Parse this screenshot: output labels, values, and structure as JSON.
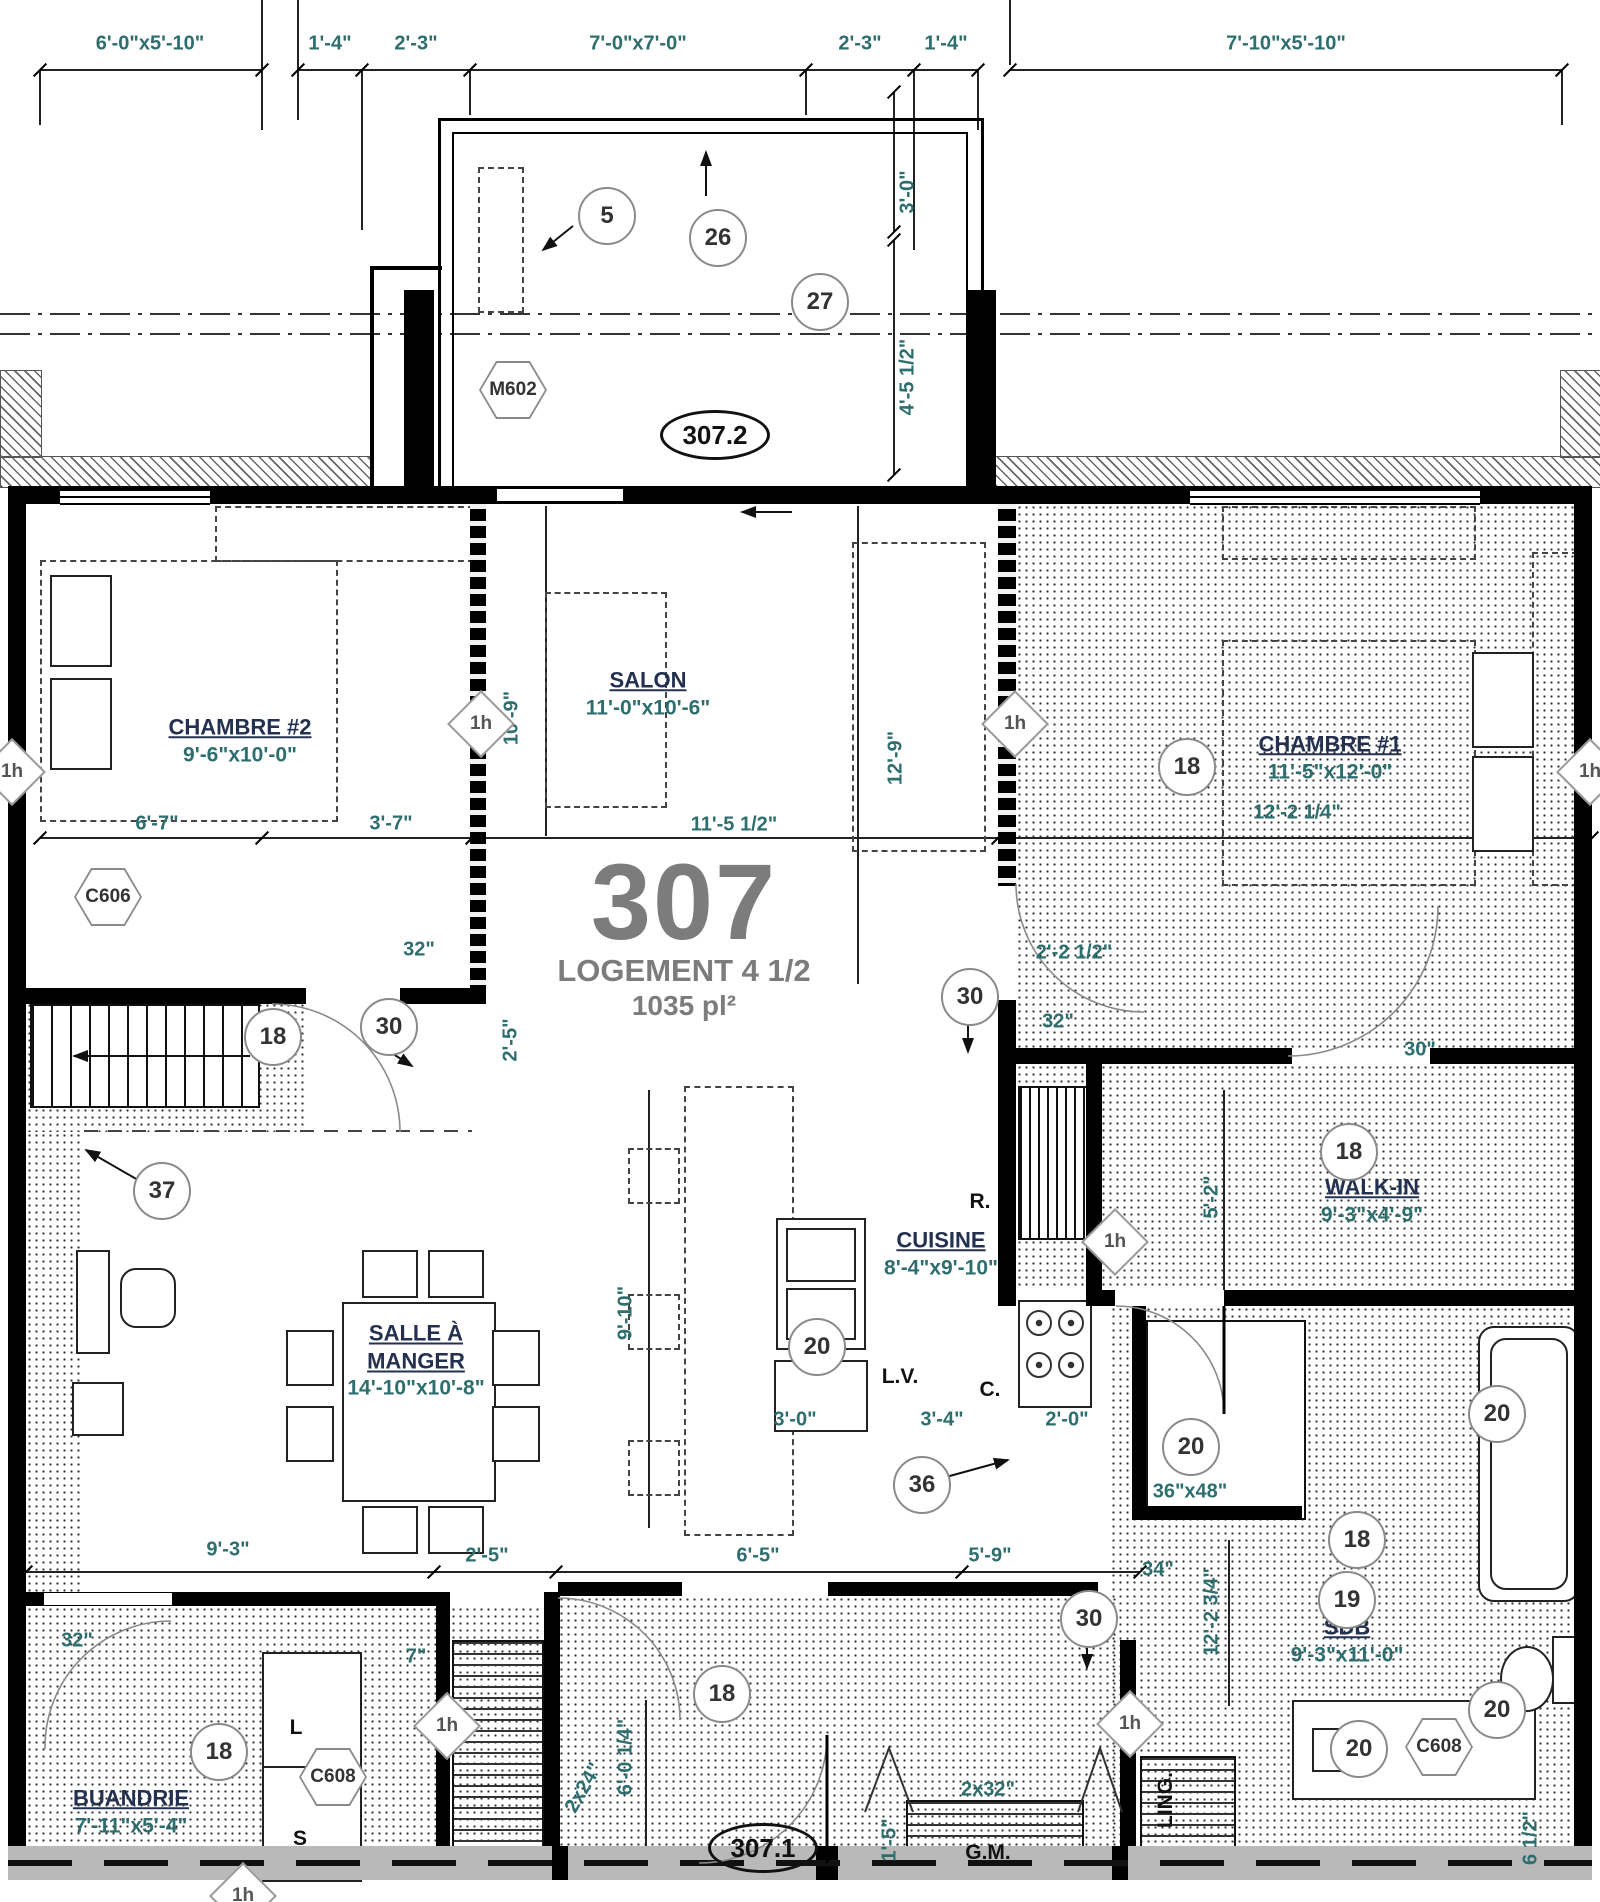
{
  "title": {
    "unit": "307",
    "type": "LOGEMENT 4 1/2",
    "area": "1035 pl²"
  },
  "colors": {
    "dim_text": "#2e6e6e",
    "room_text": "#233050",
    "title_text": "#7c7c7c",
    "wall": "#000000",
    "band": "#b9b9b9"
  },
  "top_dims": [
    {
      "t": "6'-0\"x5'-10\"",
      "x": 150,
      "y": 44
    },
    {
      "t": "1'-4\"",
      "x": 330,
      "y": 44
    },
    {
      "t": "2'-3\"",
      "x": 416,
      "y": 44
    },
    {
      "t": "7'-0\"x7'-0\"",
      "x": 638,
      "y": 44
    },
    {
      "t": "2'-3\"",
      "x": 860,
      "y": 44
    },
    {
      "t": "1'-4\"",
      "x": 946,
      "y": 44
    },
    {
      "t": "7'-10\"x5'-10\"",
      "x": 1286,
      "y": 44
    }
  ],
  "dims": [
    {
      "t": "3'-0\"",
      "x": 908,
      "y": 192,
      "rot": true
    },
    {
      "t": "4'-5 1/2\"",
      "x": 908,
      "y": 377,
      "rot": true
    },
    {
      "t": "10'-9\"",
      "x": 512,
      "y": 718,
      "rot": true
    },
    {
      "t": "12'-9\"",
      "x": 896,
      "y": 758,
      "rot": true
    },
    {
      "t": "6'-7\"",
      "x": 157,
      "y": 824
    },
    {
      "t": "3'-7\"",
      "x": 391,
      "y": 824
    },
    {
      "t": "11'-5 1/2\"",
      "x": 734,
      "y": 825
    },
    {
      "t": "12'-2 1/4\"",
      "x": 1297,
      "y": 813
    },
    {
      "t": "32\"",
      "x": 419,
      "y": 950
    },
    {
      "t": "2'-5\"",
      "x": 511,
      "y": 1040,
      "rot": true
    },
    {
      "t": "2'-2 1/2\"",
      "x": 1074,
      "y": 953
    },
    {
      "t": "32\"",
      "x": 1058,
      "y": 1022
    },
    {
      "t": "30\"",
      "x": 1420,
      "y": 1050
    },
    {
      "t": "5'-2\"",
      "x": 1212,
      "y": 1197,
      "rot": true
    },
    {
      "t": "9'-10\"",
      "x": 626,
      "y": 1313,
      "rot": true
    },
    {
      "t": "3'-0\"",
      "x": 795,
      "y": 1420
    },
    {
      "t": "3'-4\"",
      "x": 942,
      "y": 1420
    },
    {
      "t": "2'-0\"",
      "x": 1067,
      "y": 1420
    },
    {
      "t": "36\"x48\"",
      "x": 1190,
      "y": 1492
    },
    {
      "t": "9'-3\"",
      "x": 228,
      "y": 1550
    },
    {
      "t": "2'-5\"",
      "x": 487,
      "y": 1556
    },
    {
      "t": "6'-5\"",
      "x": 758,
      "y": 1556
    },
    {
      "t": "5'-9\"",
      "x": 990,
      "y": 1556
    },
    {
      "t": "34\"",
      "x": 1158,
      "y": 1570
    },
    {
      "t": "12'-2 3/4\"",
      "x": 1212,
      "y": 1612,
      "rot": true
    },
    {
      "t": "32\"",
      "x": 77,
      "y": 1641
    },
    {
      "t": "7\"",
      "x": 416,
      "y": 1657
    },
    {
      "t": "2x24\"",
      "x": 584,
      "y": 1788,
      "rot60": true
    },
    {
      "t": "6'-0 1/4\"",
      "x": 626,
      "y": 1757,
      "rot": true
    },
    {
      "t": "1'-5\"",
      "x": 890,
      "y": 1840,
      "rot": true
    },
    {
      "t": "2x32\"",
      "x": 988,
      "y": 1790
    },
    {
      "t": "6 1/2\"",
      "x": 1531,
      "y": 1838,
      "rot": true
    }
  ],
  "rooms": [
    {
      "name": "CHAMBRE #2",
      "size": "9'-6\"x10'-0\"",
      "x": 240,
      "y": 740
    },
    {
      "name": "SALON",
      "size": "11'-0\"x10'-6\"",
      "x": 648,
      "y": 693
    },
    {
      "name": "CHAMBRE #1",
      "size": "11'-5\"x12'-0\"",
      "x": 1330,
      "y": 757
    },
    {
      "name": "WALK-IN",
      "size": "9'-3\"x4'-9\"",
      "x": 1372,
      "y": 1200
    },
    {
      "name": "SALLE À\nMANGER",
      "size": "14'-10\"x10'-8\"",
      "x": 416,
      "y": 1360
    },
    {
      "name": "CUISINE",
      "size": "8'-4\"x9'-10\"",
      "x": 941,
      "y": 1253
    },
    {
      "name": "SDB",
      "size": "9'-3\"x11'-0\"",
      "x": 1347,
      "y": 1640
    },
    {
      "name": "BUANDRIE",
      "size": "7'-11\"x5'-4\"",
      "x": 131,
      "y": 1811
    }
  ],
  "circles": [
    {
      "n": "5",
      "x": 605,
      "y": 214
    },
    {
      "n": "26",
      "x": 716,
      "y": 236
    },
    {
      "n": "27",
      "x": 818,
      "y": 300
    },
    {
      "n": "18",
      "x": 1185,
      "y": 765
    },
    {
      "n": "30",
      "x": 387,
      "y": 1025
    },
    {
      "n": "18",
      "x": 271,
      "y": 1035
    },
    {
      "n": "30",
      "x": 968,
      "y": 995
    },
    {
      "n": "37",
      "x": 160,
      "y": 1189
    },
    {
      "n": "18",
      "x": 1347,
      "y": 1150
    },
    {
      "n": "20",
      "x": 815,
      "y": 1345
    },
    {
      "n": "36",
      "x": 920,
      "y": 1483
    },
    {
      "n": "20",
      "x": 1189,
      "y": 1445
    },
    {
      "n": "20",
      "x": 1495,
      "y": 1412
    },
    {
      "n": "18",
      "x": 1355,
      "y": 1538
    },
    {
      "n": "19",
      "x": 1345,
      "y": 1598
    },
    {
      "n": "30",
      "x": 1087,
      "y": 1617
    },
    {
      "n": "18",
      "x": 720,
      "y": 1692
    },
    {
      "n": "18",
      "x": 217,
      "y": 1750
    },
    {
      "n": "20",
      "x": 1357,
      "y": 1747
    },
    {
      "n": "20",
      "x": 1495,
      "y": 1708
    }
  ],
  "hexes": [
    {
      "n": "M602",
      "x": 513,
      "y": 390
    },
    {
      "n": "C606",
      "x": 108,
      "y": 897
    },
    {
      "n": "C608",
      "x": 333,
      "y": 1777
    },
    {
      "n": "C608",
      "x": 1439,
      "y": 1747
    }
  ],
  "ovals": [
    {
      "n": "307.2",
      "x": 712,
      "y": 432
    },
    {
      "n": "307.1",
      "x": 760,
      "y": 1845
    }
  ],
  "diamonds": [
    {
      "n": "1h",
      "x": 479,
      "y": 722
    },
    {
      "n": "1h",
      "x": 1013,
      "y": 722
    },
    {
      "n": "1h",
      "x": 10,
      "y": 770
    },
    {
      "n": "1h",
      "x": 1588,
      "y": 770
    },
    {
      "n": "1h",
      "x": 1113,
      "y": 1240
    },
    {
      "n": "1h",
      "x": 445,
      "y": 1724
    },
    {
      "n": "1h",
      "x": 1128,
      "y": 1722
    },
    {
      "n": "1h",
      "x": 241,
      "y": 1894
    }
  ],
  "small_labels": [
    {
      "t": "R.",
      "x": 980,
      "y": 1202
    },
    {
      "t": "L.V.",
      "x": 900,
      "y": 1377
    },
    {
      "t": "C.",
      "x": 990,
      "y": 1390
    },
    {
      "t": "L",
      "x": 296,
      "y": 1728
    },
    {
      "t": "S",
      "x": 300,
      "y": 1839
    },
    {
      "t": "G.M.",
      "x": 988,
      "y": 1853
    },
    {
      "t": "LING.",
      "x": 1166,
      "y": 1800,
      "rot": true
    }
  ]
}
